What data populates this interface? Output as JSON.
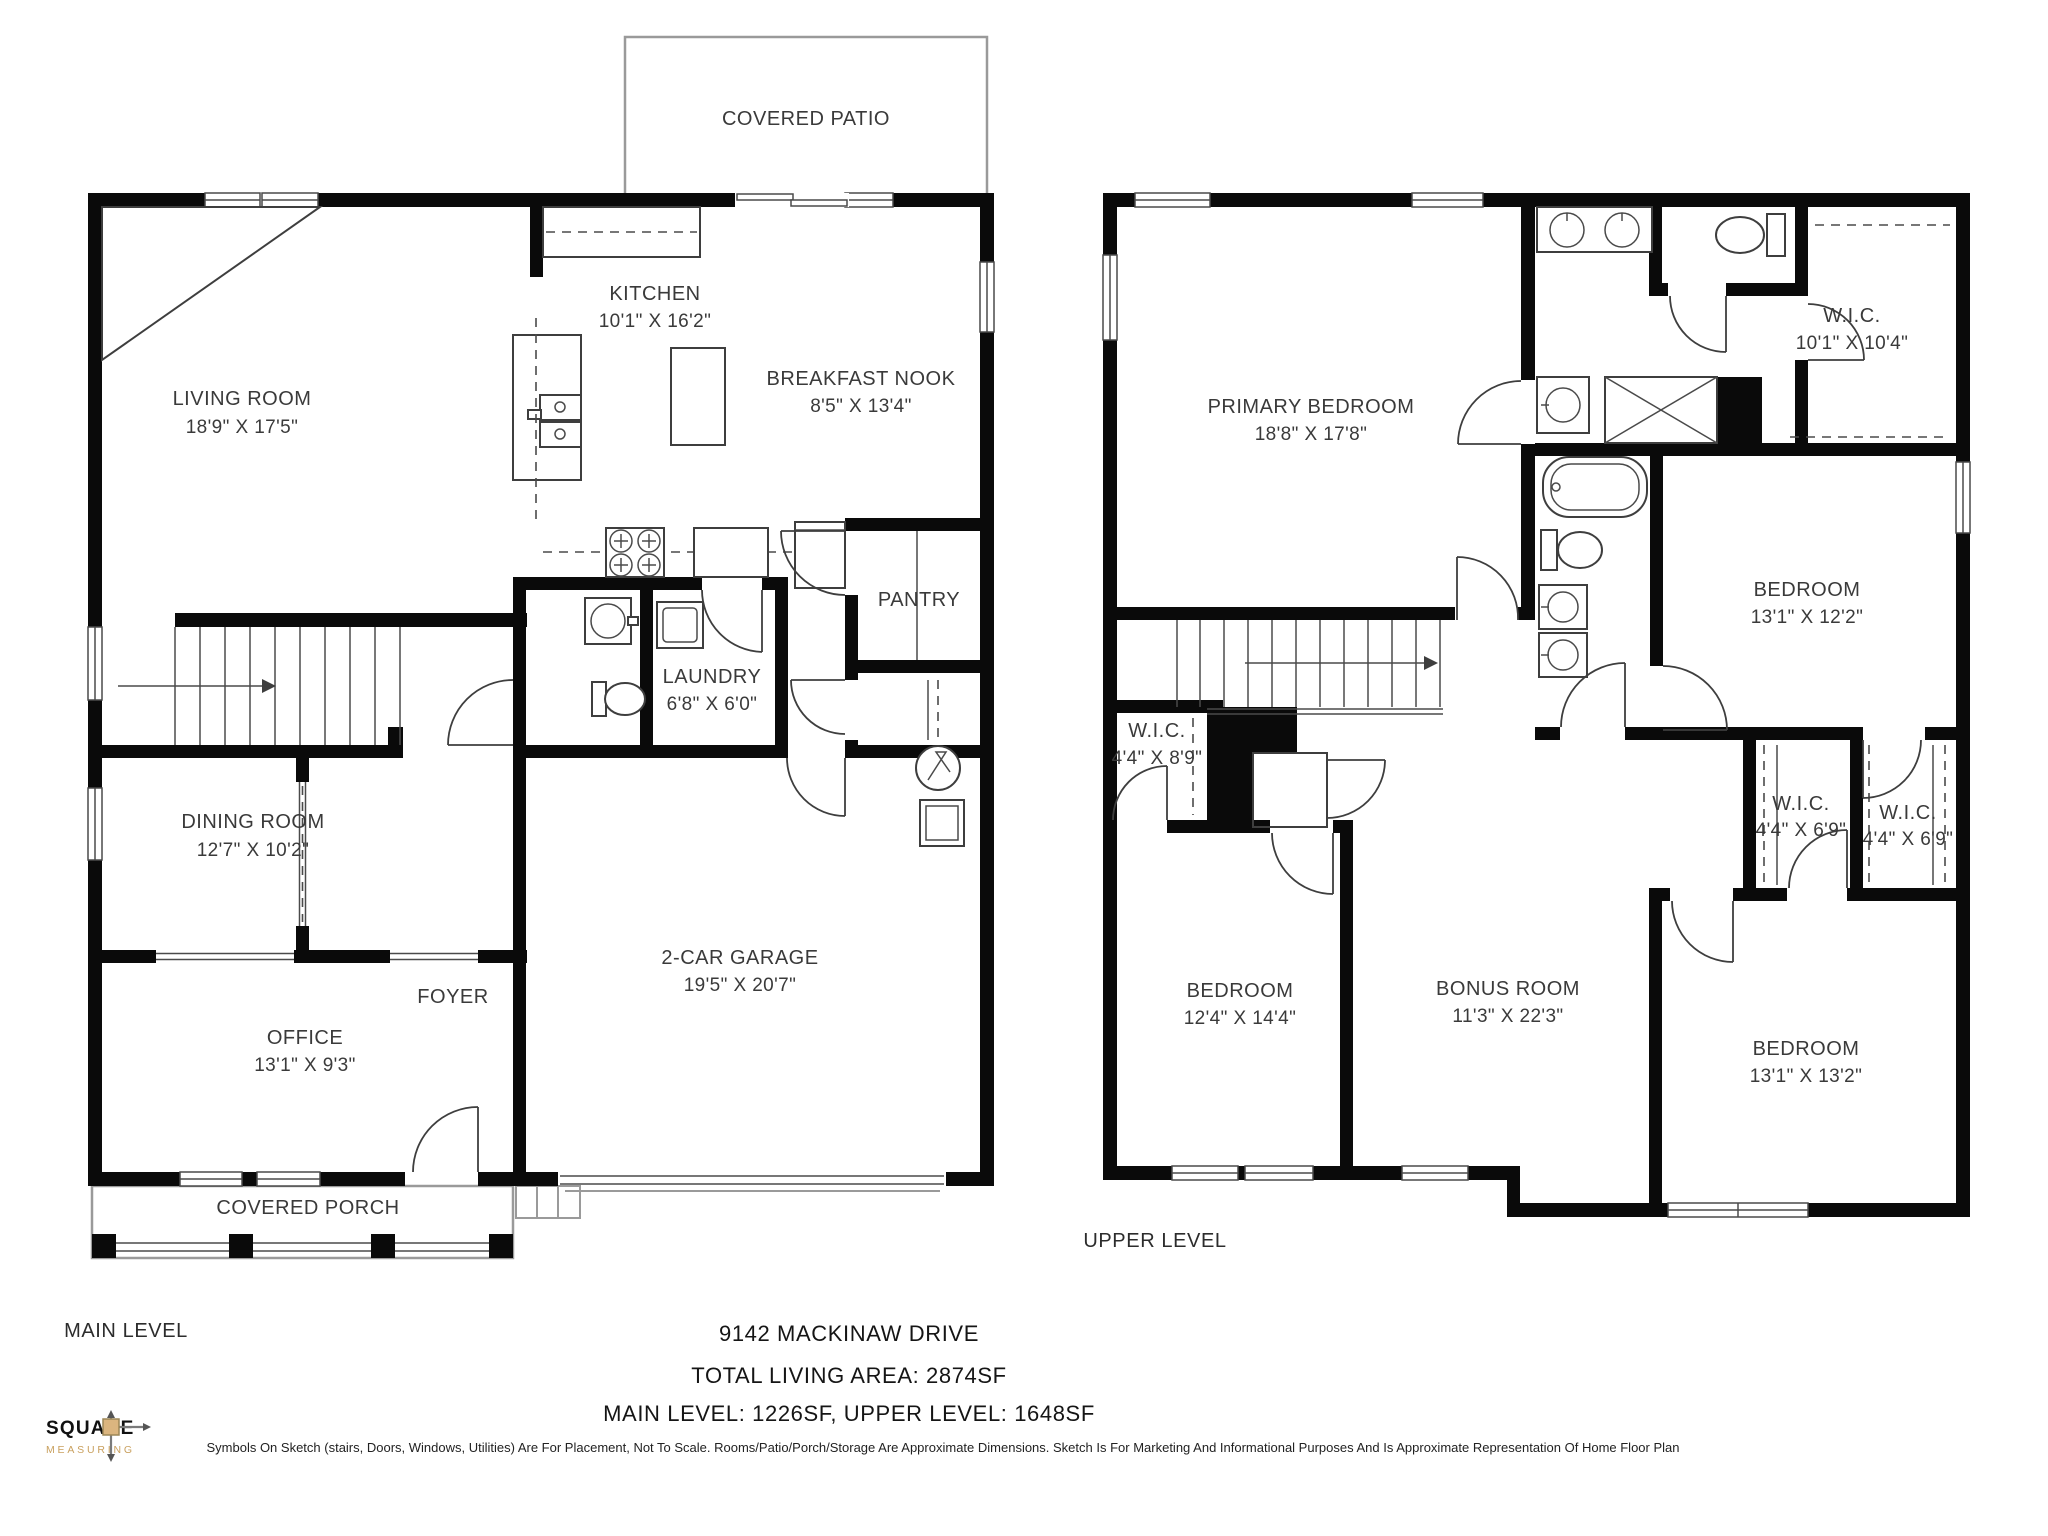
{
  "page": {
    "address_line": "9142 MACKINAW DRIVE",
    "total_area_line": "TOTAL LIVING AREA: 2874SF",
    "levels_line": "MAIN LEVEL: 1226SF, UPPER LEVEL: 1648SF",
    "disclaimer": "Symbols On Sketch (stairs, Doors, Windows, Utilities) Are For Placement, Not To Scale. Rooms/Patio/Porch/Storage Are Approximate Dimensions. Sketch Is For Marketing And Informational Purposes And Is Approximate Representation Of Home Floor Plan"
  },
  "logo": {
    "name": "SQUARE",
    "tagline": "MEASURING"
  },
  "main_level": {
    "title": "MAIN LEVEL",
    "covered_patio": {
      "name": "COVERED PATIO"
    },
    "living_room": {
      "name": "LIVING ROOM",
      "dims": "18'9\" X 17'5\""
    },
    "kitchen": {
      "name": "KITCHEN",
      "dims": "10'1\" X 16'2\""
    },
    "breakfast_nook": {
      "name": "BREAKFAST NOOK",
      "dims": "8'5\" X 13'4\""
    },
    "pantry": {
      "name": "PANTRY"
    },
    "laundry": {
      "name": "LAUNDRY",
      "dims": "6'8\" X 6'0\""
    },
    "dining_room": {
      "name": "DINING ROOM",
      "dims": "12'7\" X 10'2\""
    },
    "foyer": {
      "name": "FOYER"
    },
    "office": {
      "name": "OFFICE",
      "dims": "13'1\" X 9'3\""
    },
    "garage": {
      "name": "2-CAR GARAGE",
      "dims": "19'5\" X 20'7\""
    },
    "covered_porch": {
      "name": "COVERED PORCH"
    }
  },
  "upper_level": {
    "title": "UPPER LEVEL",
    "primary_bedroom": {
      "name": "PRIMARY BEDROOM",
      "dims": "18'8\" X 17'8\""
    },
    "primary_wic": {
      "name": "W.I.C.",
      "dims": "10'1\" X 10'4\""
    },
    "bedroom_2": {
      "name": "BEDROOM",
      "dims": "13'1\" X 12'2\""
    },
    "hall_wic": {
      "name": "W.I.C.",
      "dims": "4'4\" X 8'9\""
    },
    "bedroom_3": {
      "name": "BEDROOM",
      "dims": "12'4\" X 14'4\""
    },
    "bonus_room": {
      "name": "BONUS ROOM",
      "dims": "11'3\" X 22'3\""
    },
    "wic_left": {
      "name": "W.I.C.",
      "dims": "4'4\" X 6'9\""
    },
    "wic_right": {
      "name": "W.I.C.",
      "dims": "4'4\" X 6'9\""
    },
    "bedroom_4": {
      "name": "BEDROOM",
      "dims": "13'1\" X 13'2\""
    }
  }
}
